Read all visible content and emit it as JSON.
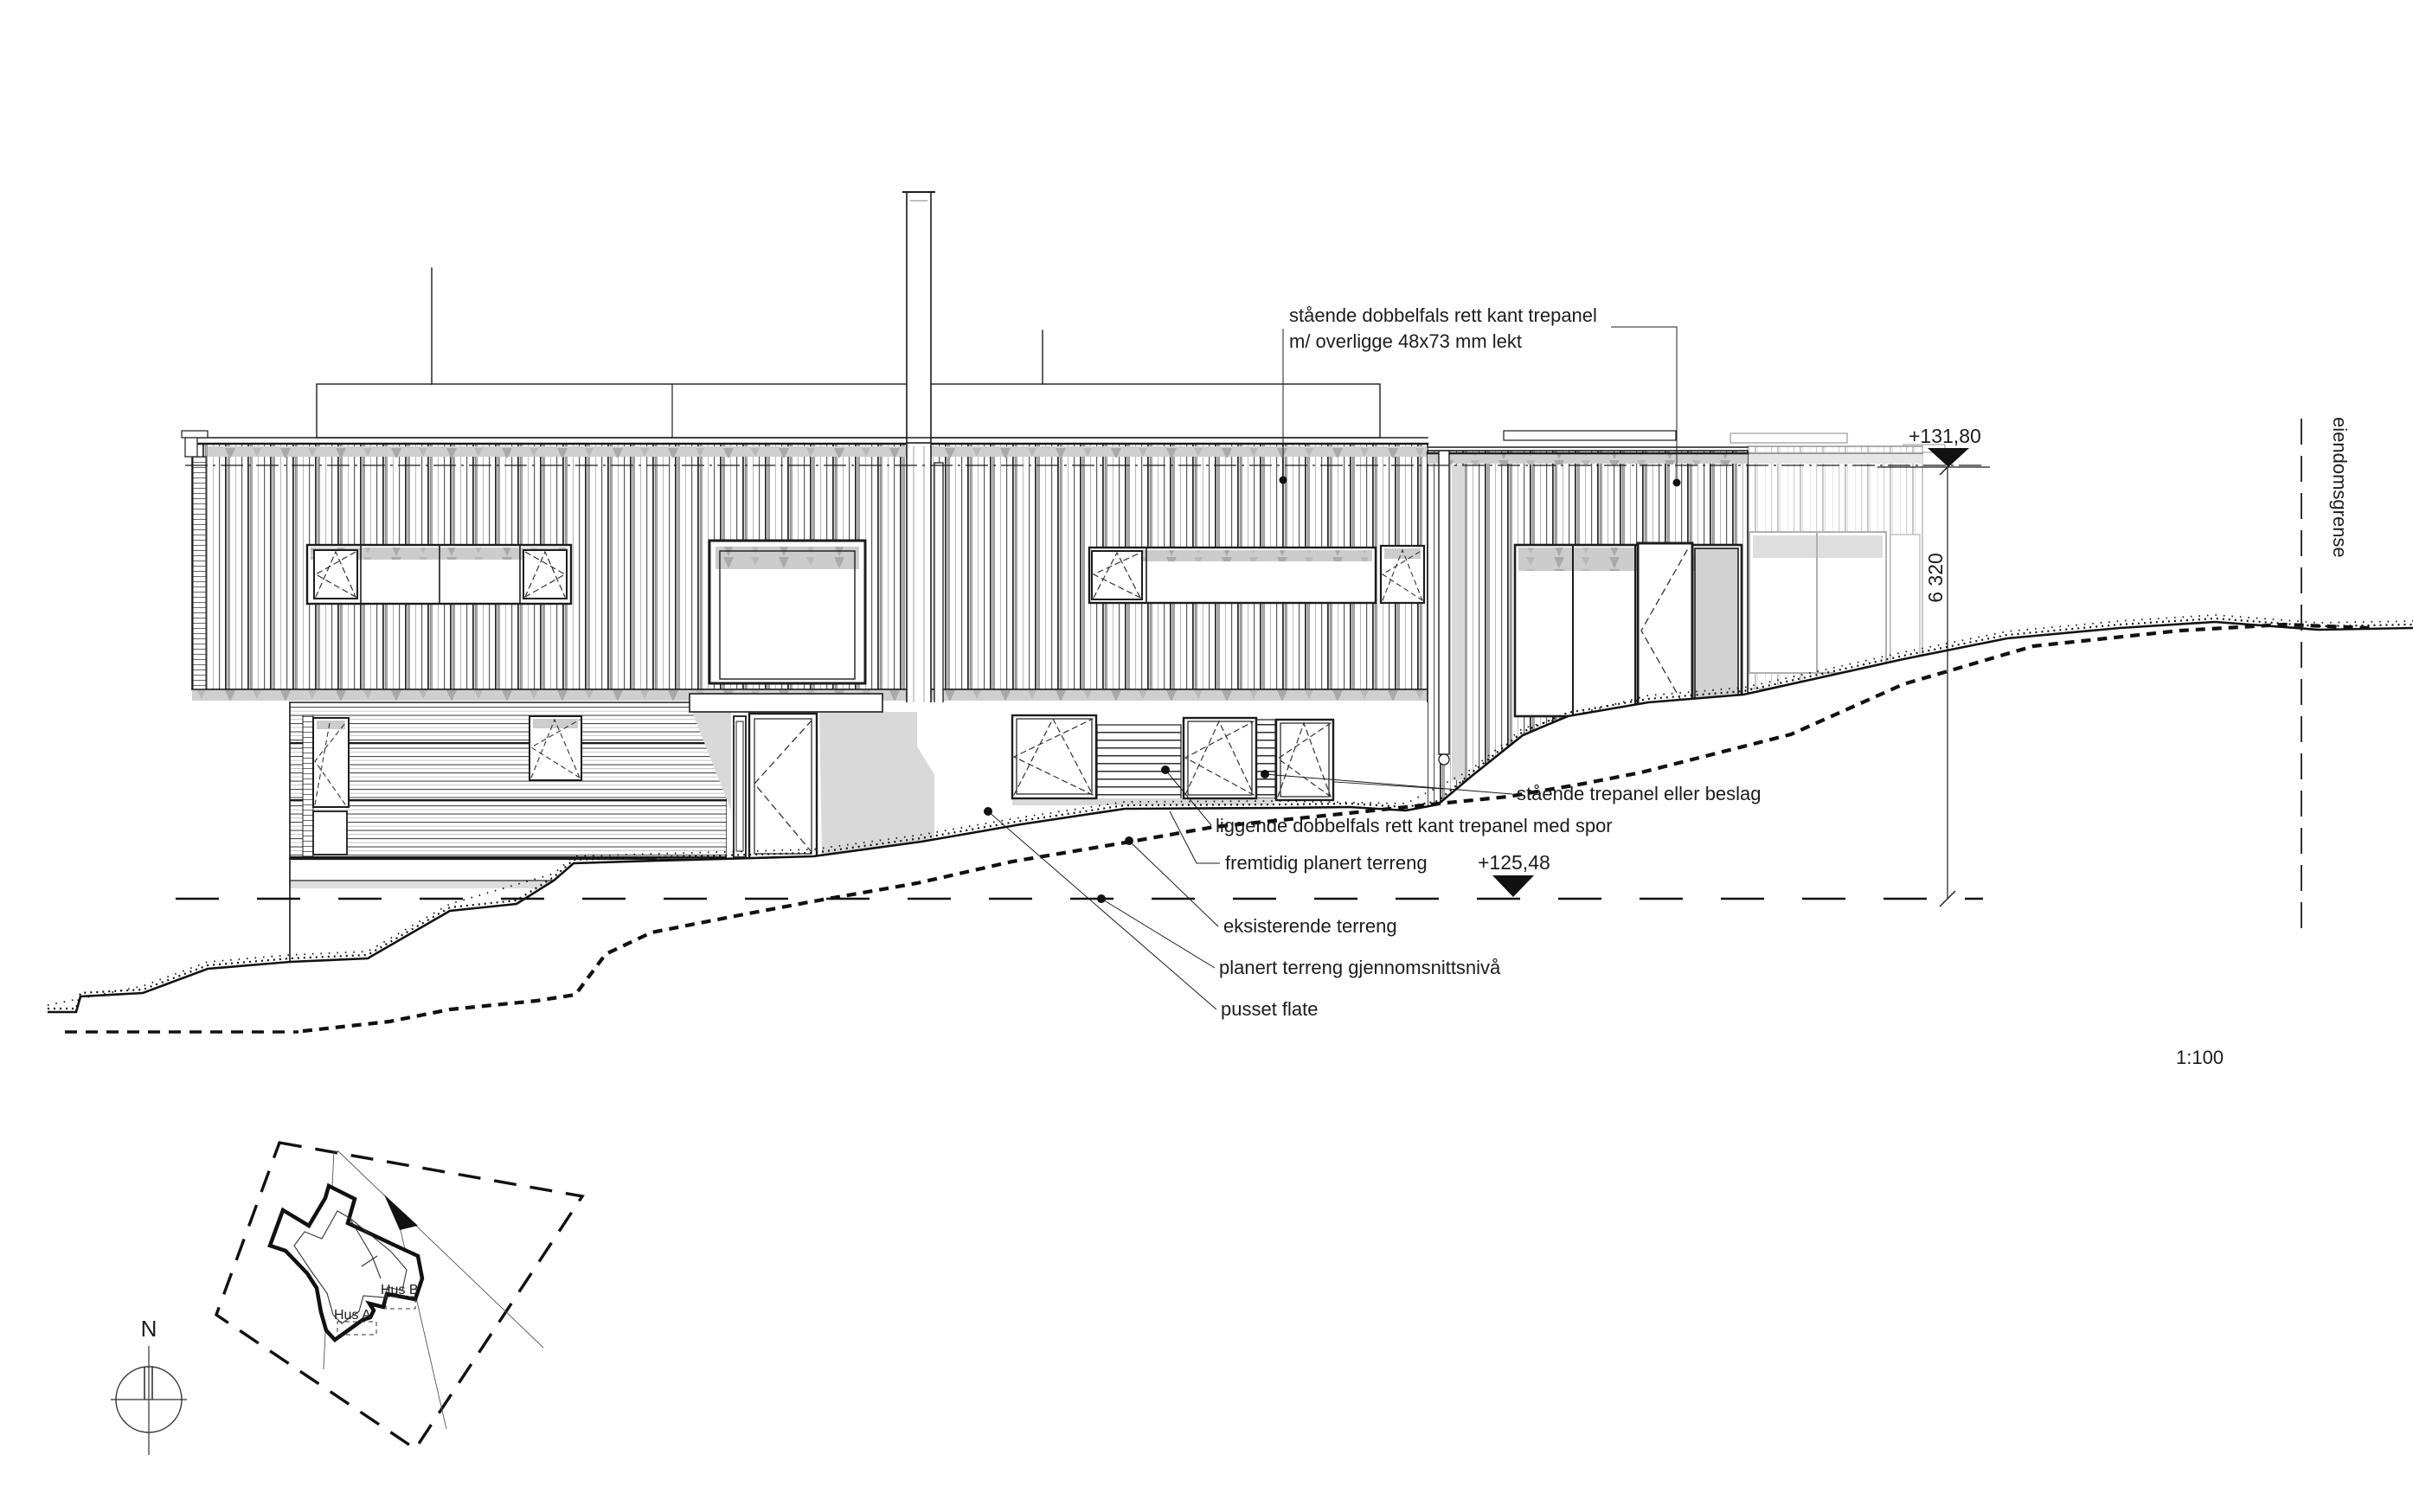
{
  "drawing": {
    "type": "architectural-elevation",
    "scale_label": "1:100",
    "annotation_top": {
      "line1": "stående dobbelfals rett kant trepanel",
      "line2": "m/ overligge 48x73 mm lekt"
    },
    "labels": {
      "standing_panel": "stående trepanel eller beslag",
      "lying_panel": "liggende dobbelfals rett kant trepanel med spor",
      "future_terrain": "fremtidig planert terreng",
      "existing_terrain": "eksisterende terreng",
      "avg_terrain": "planert terreng gjennomsnittsnivå",
      "plaster": "pusset flate",
      "property_line": "eiendomsgrense"
    },
    "levels": {
      "roof_elevation": "+131,80",
      "terrain_elevation": "+125,48",
      "height_dimension": "6 320"
    }
  },
  "site_plan": {
    "house_a_label": "Hus A",
    "house_b_label": "Hus B",
    "north_label": "N"
  },
  "colors": {
    "line": "#1c1c1c",
    "shadow": "#d9d9d9",
    "band_gray": "#cccccc",
    "ghost": "#b5b5b5",
    "background": "#ffffff"
  }
}
